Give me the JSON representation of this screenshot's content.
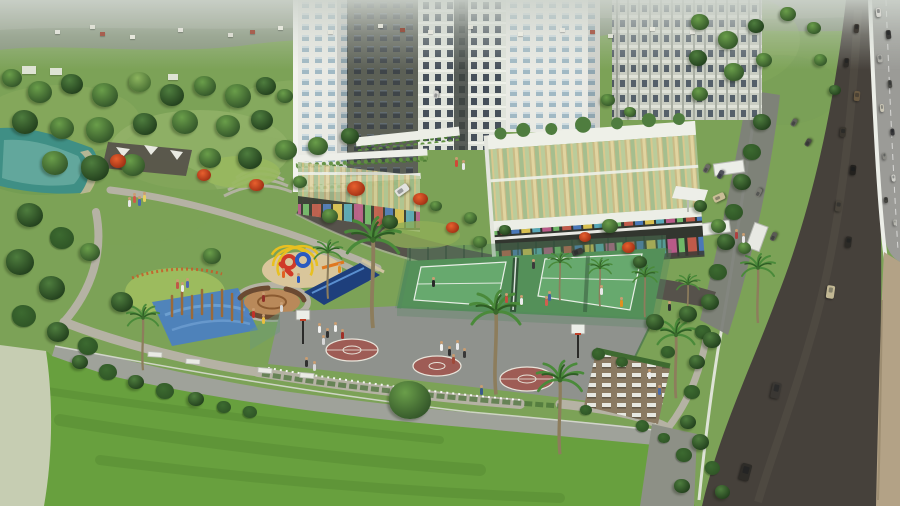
{
  "meta": {
    "title": "Aerial 3D architectural rendering of a residential township with sports courts, playground park, lawns and an adjacent highway"
  },
  "palette": {
    "field": "#7ca257",
    "fieldLight": "#a4bd76",
    "hill": "#85927b",
    "lake": "#3f8f85",
    "paleWater": "#c6cdb2",
    "lawn": "#68a03e",
    "lawnYellow": "#9cbb5e",
    "path": "#b5b2a4",
    "sand": "#d9c69b",
    "mosaicBlue": "#4a7fc2",
    "mosaicTan": "#b9895a",
    "bench": "#6b4a32",
    "poolNavy": "#1e3f7c",
    "poleBrown": "#9a6a3a",
    "towerWhite": "#e9eae4",
    "towerPale": "#dfe3da",
    "windowBlue": "#9db6c2",
    "windowDark": "#46505a",
    "concrete": "#c9cdc2",
    "asphalt": "#46413b",
    "asphaltIn": "#56524b",
    "highway": "#9b9b97",
    "wallTan": "#b3a286",
    "white": "#eceee8",
    "bball": "#8f928d",
    "maroon": "#9e5c55",
    "tennisApron": "#549059",
    "tennisCourt": "#67a96e",
    "courtLine": "#e9efe7",
    "fence": "#4a7a55",
    "glassGold": "#cabb86",
    "terrace": "#8a7a62",
    "playYellow": "#e8c020",
    "playRed": "#d03a28",
    "playBlue": "#2a5ac0",
    "playOrange": "#e07820",
    "palmFrond": "#4a8a3a",
    "palmTrunk": "#8d7d5c",
    "hedge": "#2f5526",
    "treeDark1": "#4e7d3e",
    "treeDark2": "#24421e",
    "treeMid1": "#6a9e4a",
    "treeMid2": "#35582a",
    "treeLight1": "#8cb45e",
    "treeLight2": "#4a7034"
  },
  "scene": {
    "trees": [
      [
        12,
        78,
        20,
        "mid"
      ],
      [
        40,
        92,
        24,
        "mid"
      ],
      [
        72,
        84,
        22,
        "dark"
      ],
      [
        105,
        95,
        26,
        "mid"
      ],
      [
        140,
        82,
        22,
        "light"
      ],
      [
        172,
        95,
        24,
        "dark"
      ],
      [
        205,
        86,
        22,
        "mid"
      ],
      [
        238,
        96,
        26,
        "mid"
      ],
      [
        266,
        86,
        20,
        "dark"
      ],
      [
        285,
        96,
        16,
        "mid"
      ],
      [
        25,
        122,
        26,
        "dark"
      ],
      [
        62,
        128,
        24,
        "mid"
      ],
      [
        100,
        130,
        28,
        "mid"
      ],
      [
        145,
        124,
        24,
        "dark"
      ],
      [
        185,
        122,
        26,
        "mid"
      ],
      [
        228,
        126,
        24,
        "mid"
      ],
      [
        262,
        120,
        22,
        "dark"
      ],
      [
        55,
        163,
        26,
        "mid"
      ],
      [
        95,
        168,
        28,
        "dark"
      ],
      [
        133,
        165,
        24,
        "mid"
      ],
      [
        210,
        158,
        22,
        "mid"
      ],
      [
        250,
        158,
        24,
        "dark"
      ],
      [
        286,
        150,
        22,
        "mid"
      ],
      [
        318,
        146,
        20,
        "mid"
      ],
      [
        350,
        136,
        18,
        "dark"
      ],
      [
        700,
        22,
        18,
        "mid"
      ],
      [
        728,
        40,
        20,
        "mid"
      ],
      [
        756,
        26,
        16,
        "dark"
      ],
      [
        788,
        14,
        16,
        "mid"
      ],
      [
        814,
        28,
        14,
        "mid"
      ],
      [
        698,
        58,
        18,
        "dark"
      ],
      [
        734,
        72,
        20,
        "mid"
      ],
      [
        764,
        60,
        16,
        "mid"
      ],
      [
        700,
        94,
        16,
        "mid"
      ],
      [
        820,
        60,
        13,
        "mid"
      ],
      [
        835,
        90,
        12,
        "dark"
      ],
      [
        762,
        122,
        18,
        "dark"
      ],
      [
        752,
        152,
        18,
        "hedge"
      ],
      [
        742,
        182,
        18,
        "dark"
      ],
      [
        734,
        212,
        18,
        "hedge"
      ],
      [
        726,
        242,
        18,
        "dark"
      ],
      [
        718,
        272,
        18,
        "hedge"
      ],
      [
        710,
        302,
        18,
        "dark"
      ],
      [
        703,
        332,
        16,
        "hedge"
      ],
      [
        697,
        362,
        16,
        "dark"
      ],
      [
        692,
        392,
        16,
        "hedge"
      ],
      [
        688,
        422,
        16,
        "dark"
      ],
      [
        684,
        455,
        16,
        "hedge"
      ],
      [
        682,
        486,
        16,
        "dark"
      ],
      [
        30,
        215,
        26,
        "dark"
      ],
      [
        62,
        238,
        24,
        "hedge"
      ],
      [
        20,
        262,
        28,
        "dark"
      ],
      [
        52,
        288,
        26,
        "dark"
      ],
      [
        24,
        316,
        24,
        "hedge"
      ],
      [
        58,
        332,
        22,
        "dark"
      ],
      [
        88,
        346,
        20,
        "hedge"
      ],
      [
        80,
        362,
        16,
        "dark"
      ],
      [
        108,
        372,
        18,
        "hedge"
      ],
      [
        136,
        382,
        16,
        "dark"
      ],
      [
        165,
        391,
        18,
        "hedge"
      ],
      [
        196,
        399,
        16,
        "dark"
      ],
      [
        224,
        407,
        14,
        "hedge"
      ],
      [
        90,
        252,
        20,
        "mid"
      ],
      [
        122,
        302,
        22,
        "dark"
      ],
      [
        212,
        256,
        18,
        "mid"
      ],
      [
        330,
        216,
        16,
        "mid"
      ],
      [
        300,
        182,
        14,
        "mid"
      ],
      [
        390,
        222,
        16,
        "dark"
      ],
      [
        480,
        242,
        14,
        "mid"
      ],
      [
        610,
        226,
        16,
        "mid"
      ],
      [
        640,
        262,
        14,
        "dark"
      ],
      [
        655,
        322,
        18,
        "dark"
      ],
      [
        688,
        314,
        18,
        "dark"
      ],
      [
        712,
        340,
        18,
        "dark"
      ],
      [
        668,
        352,
        14,
        "hedge"
      ],
      [
        410,
        400,
        42,
        "mid"
      ],
      [
        250,
        412,
        14,
        "hedge"
      ],
      [
        598,
        354,
        13,
        "hedge"
      ],
      [
        622,
        362,
        12,
        "hedge"
      ],
      [
        586,
        410,
        12,
        "hedge"
      ],
      [
        642,
        426,
        13,
        "hedge"
      ],
      [
        664,
        438,
        12,
        "hedge"
      ],
      [
        718,
        226,
        15,
        "mid"
      ],
      [
        744,
        248,
        13,
        "mid"
      ],
      [
        700,
        206,
        13,
        "dark"
      ],
      [
        608,
        100,
        14,
        "mid"
      ],
      [
        630,
        112,
        12,
        "mid"
      ],
      [
        700,
        442,
        17,
        "dark"
      ],
      [
        712,
        468,
        15,
        "hedge"
      ],
      [
        722,
        492,
        15,
        "dark"
      ],
      [
        470,
        218,
        13,
        "mid"
      ],
      [
        505,
        230,
        12,
        "dark"
      ],
      [
        436,
        206,
        12,
        "mid"
      ]
    ],
    "flowering_trees": [
      [
        118,
        162,
        16
      ],
      [
        204,
        176,
        14
      ],
      [
        256,
        186,
        15
      ],
      [
        356,
        190,
        18
      ],
      [
        420,
        200,
        15
      ],
      [
        452,
        228,
        13
      ],
      [
        585,
        238,
        12
      ],
      [
        628,
        248,
        13
      ]
    ],
    "palms": [
      [
        373,
        240,
        1.6
      ],
      [
        496,
        312,
        1.5
      ],
      [
        560,
        380,
        1.35
      ],
      [
        676,
        335,
        1.15
      ],
      [
        560,
        262,
        0.7
      ],
      [
        600,
        268,
        0.7
      ],
      [
        645,
        276,
        0.75
      ],
      [
        688,
        284,
        0.7
      ],
      [
        143,
        318,
        0.95
      ],
      [
        328,
        252,
        0.85
      ],
      [
        758,
        268,
        1.0
      ]
    ],
    "people": [
      [
        318,
        326,
        "#f2f2f0"
      ],
      [
        326,
        331,
        "#303030"
      ],
      [
        334,
        325,
        "#f2f2f0"
      ],
      [
        341,
        332,
        "#a03028"
      ],
      [
        322,
        338,
        "#d8d8d8"
      ],
      [
        440,
        344,
        "#f2f2f0"
      ],
      [
        448,
        349,
        "#303030"
      ],
      [
        456,
        343,
        "#e8e8e8"
      ],
      [
        463,
        351,
        "#383838"
      ],
      [
        452,
        357,
        "#a04838"
      ],
      [
        432,
        280,
        "#282828"
      ],
      [
        532,
        262,
        "#3a3a3a"
      ],
      [
        600,
        288,
        "#e8e8e8"
      ],
      [
        305,
        360,
        "#303030"
      ],
      [
        313,
        364,
        "#d8d8d8"
      ],
      [
        480,
        388,
        "#3a5a8a"
      ],
      [
        658,
        388,
        "#4a6aaa"
      ],
      [
        505,
        296,
        "#c05040"
      ],
      [
        520,
        298,
        "#ececec"
      ],
      [
        548,
        294,
        "#4060a0"
      ],
      [
        620,
        300,
        "#e09020"
      ],
      [
        668,
        304,
        "#303030"
      ],
      [
        735,
        232,
        "#b04040"
      ],
      [
        742,
        236,
        "#e8e8e8"
      ],
      [
        133,
        196,
        "#d05848"
      ],
      [
        138,
        199,
        "#4868b0"
      ],
      [
        143,
        195,
        "#e8d060"
      ],
      [
        128,
        200,
        "#e8e8e8"
      ],
      [
        176,
        282,
        "#c05848"
      ],
      [
        181,
        285,
        "#ececec"
      ],
      [
        186,
        281,
        "#5068b0"
      ],
      [
        282,
        271,
        "#e06020"
      ],
      [
        297,
        276,
        "#2858c0"
      ],
      [
        252,
        311,
        "#c03028"
      ],
      [
        262,
        317,
        "#e8c040"
      ],
      [
        262,
        295,
        "#903028"
      ],
      [
        280,
        305,
        "#d8d8d8"
      ],
      [
        338,
        266,
        "#e09020"
      ],
      [
        455,
        160,
        "#d04838"
      ],
      [
        462,
        163,
        "#e8e8e8"
      ],
      [
        648,
        372,
        "#ececec"
      ],
      [
        545,
        299,
        "#d06050"
      ]
    ],
    "cars": {
      "highway": [
        [
          878,
          12,
          9,
          5,
          84,
          "#d8d8d2"
        ],
        [
          888,
          34,
          9,
          5,
          84,
          "#3a3a38"
        ],
        [
          880,
          58,
          8,
          5,
          84,
          "#b0b0aa"
        ],
        [
          890,
          84,
          8,
          4,
          84,
          "#4a4a46"
        ],
        [
          882,
          108,
          8,
          4,
          85,
          "#c8c4b4"
        ],
        [
          892,
          132,
          7,
          4,
          85,
          "#38383a"
        ],
        [
          884,
          156,
          7,
          4,
          85,
          "#8a8a84"
        ],
        [
          893,
          178,
          7,
          4,
          85,
          "#d0d0ca"
        ],
        [
          886,
          200,
          6,
          4,
          86,
          "#44443f"
        ],
        [
          895,
          222,
          6,
          3,
          86,
          "#b8b8b0"
        ]
      ],
      "service_road": [
        [
          856,
          28,
          9,
          5,
          95,
          "#3f3b35"
        ],
        [
          846,
          62,
          9,
          5,
          95,
          "#2e2b27"
        ],
        [
          857,
          96,
          10,
          6,
          95,
          "#6a5a42"
        ],
        [
          843,
          132,
          10,
          6,
          96,
          "#3a362f"
        ],
        [
          853,
          170,
          10,
          6,
          96,
          "#23211e"
        ],
        [
          838,
          206,
          11,
          6,
          97,
          "#4a453c"
        ],
        [
          848,
          242,
          11,
          6,
          97,
          "#2c2a26"
        ],
        [
          830,
          292,
          13,
          8,
          98,
          "#c2b894"
        ],
        [
          776,
          390,
          16,
          9,
          102,
          "#3a3733"
        ],
        [
          745,
          472,
          17,
          10,
          105,
          "#2e2c28"
        ]
      ],
      "parking": [
        [
          706,
          168,
          9,
          5,
          -62,
          "#6a6a64"
        ],
        [
          720,
          174,
          9,
          5,
          -62,
          "#50505a"
        ],
        [
          758,
          192,
          9,
          5,
          -62,
          "#7a7a72"
        ],
        [
          794,
          122,
          8,
          5,
          -60,
          "#60605a"
        ],
        [
          808,
          142,
          8,
          5,
          -60,
          "#4a4a44"
        ],
        [
          773,
          236,
          9,
          5,
          -64,
          "#5a5a54"
        ]
      ],
      "internal": [
        [
          402,
          190,
          14,
          8,
          -35,
          "#e2e2de"
        ],
        [
          436,
          94,
          8,
          5,
          -80,
          "#d8d8d4"
        ],
        [
          577,
          252,
          11,
          6,
          -20,
          "#3c3c38"
        ],
        [
          719,
          197,
          12,
          7,
          -25,
          "#c9bd96"
        ]
      ]
    },
    "village_houses": [
      [
        55,
        30,
        "#e8e8e0"
      ],
      [
        90,
        25,
        "#e4e4da"
      ],
      [
        130,
        35,
        "#eeeee4"
      ],
      [
        178,
        28,
        "#e8e8e0"
      ],
      [
        228,
        33,
        "#e2e2d8"
      ],
      [
        278,
        26,
        "#ecece2"
      ],
      [
        328,
        30,
        "#e6e6dc"
      ],
      [
        378,
        24,
        "#eaeae0"
      ],
      [
        428,
        30,
        "#e8e8de"
      ],
      [
        468,
        25,
        "#e4e4da"
      ],
      [
        518,
        32,
        "#ecece2"
      ],
      [
        560,
        28,
        "#e8e8e0"
      ],
      [
        608,
        34,
        "#e6e6dc"
      ],
      [
        650,
        27,
        "#eaeae0"
      ],
      [
        690,
        30,
        "#e8e8e0"
      ],
      [
        100,
        32,
        "#a85848"
      ],
      [
        250,
        30,
        "#a85848"
      ],
      [
        400,
        28,
        "#9a5040"
      ],
      [
        590,
        30,
        "#a85848"
      ],
      [
        22,
        66,
        "#e9eae2",
        14,
        8
      ],
      [
        50,
        68,
        "#e9eae2",
        12,
        7
      ],
      [
        168,
        74,
        "#e9eae2",
        10,
        6
      ]
    ]
  }
}
